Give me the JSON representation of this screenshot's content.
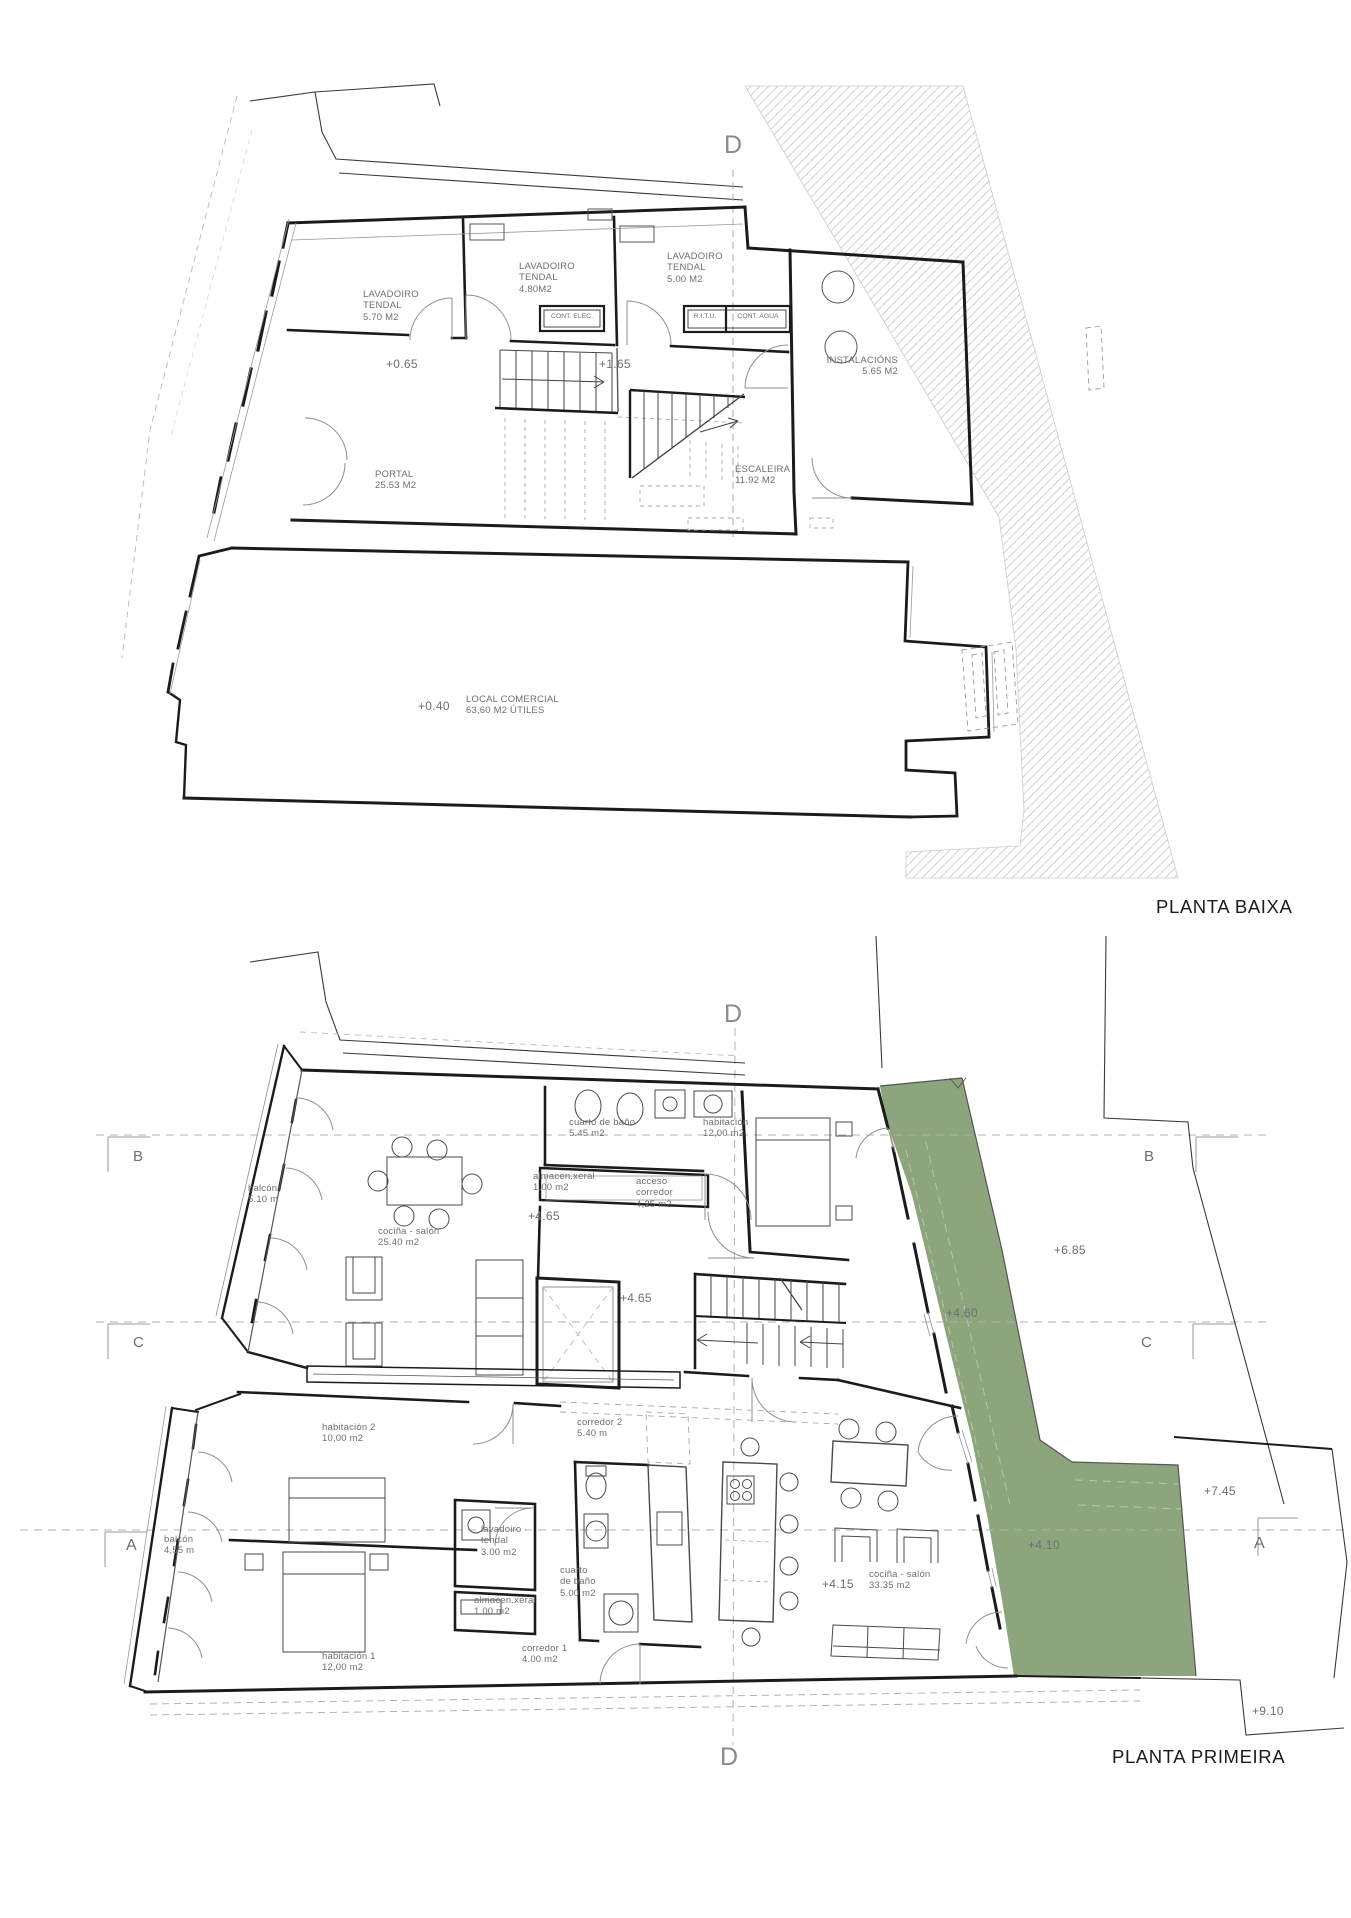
{
  "document": {
    "type": "architectural-floor-plans",
    "sheet_plans": [
      "PLANTA BAIXA",
      "PLANTA PRIMEIRA"
    ]
  },
  "colors": {
    "terrace_green": "#8CA57D",
    "wall": "#1b1b1b",
    "label_gray": "#6f6f6f",
    "hatch_gray": "#d0d0d0"
  },
  "plans": {
    "baixa": {
      "title": "PLANTA BAIXA",
      "section_marker": "D",
      "labels": {
        "lavadoiro1": "LAVADOIRO\nTENDAL\n5.70 M2",
        "lavadoiro2": "LAVADOIRO\nTENDAL\n4.80M2",
        "lavadoiro3": "LAVADOIRO\nTENDAL\n5,00 M2",
        "cont_elec": "CONT. ELEC.",
        "ritu": "R.I.T.U.",
        "cont_agua": "CONT. AGUA",
        "instalacions": "INSTALACIÓNS\n5.65 M2",
        "portal": "PORTAL\n25.53 M2",
        "escaleira": "ESCALEIRA\n11.92 M2",
        "local_comercial": "LOCAL COMERCIAL\n63,60 M2 ÚTILES"
      },
      "levels": {
        "l065": "+0.65",
        "l165": "+1.65",
        "l040": "+0.40"
      }
    },
    "primeira": {
      "title": "PLANTA PRIMEIRA",
      "section_marker_top": "D",
      "section_marker_bottom": "D",
      "grid": {
        "b": "B",
        "c": "C",
        "a": "A"
      },
      "labels": {
        "balcon_up": "balcón\n5.10 m",
        "cocina_salon_up": "cociña - salón\n25.40 m2",
        "bano_up": "cuarto de baño\n5.45 m2",
        "almacen_up": "almacen.xeral\n1,00 m2",
        "acceso": "acceso\ncorredor\n4,25 m2",
        "habitacion_up": "habitación\n12,00 m2",
        "habitacion2": "habitación 2\n10,00 m2",
        "corredor2": "corredor 2\n5.40 m",
        "balcon_low": "balcón\n4,55 m",
        "lavadoiro_tendal": "lavadoiro\ntendal\n3.00 m2",
        "almacen_low": "almacen.xeral\n1.00 m2",
        "bano_low": "cuarto\nde baño\n5.00 m2",
        "corredor1": "corredor 1\n4.00 m2",
        "habitacion1": "habitación 1\n12,00 m2",
        "cocina_salon_low": "cociña - salón\n33.35 m2"
      },
      "levels": {
        "l465a": "+4.65",
        "l465b": "+4.65",
        "l415": "+4.15",
        "l460": "+4.60",
        "l410": "+4.10",
        "l685": "+6.85",
        "l745": "+7.45",
        "l910": "+9.10"
      }
    }
  }
}
